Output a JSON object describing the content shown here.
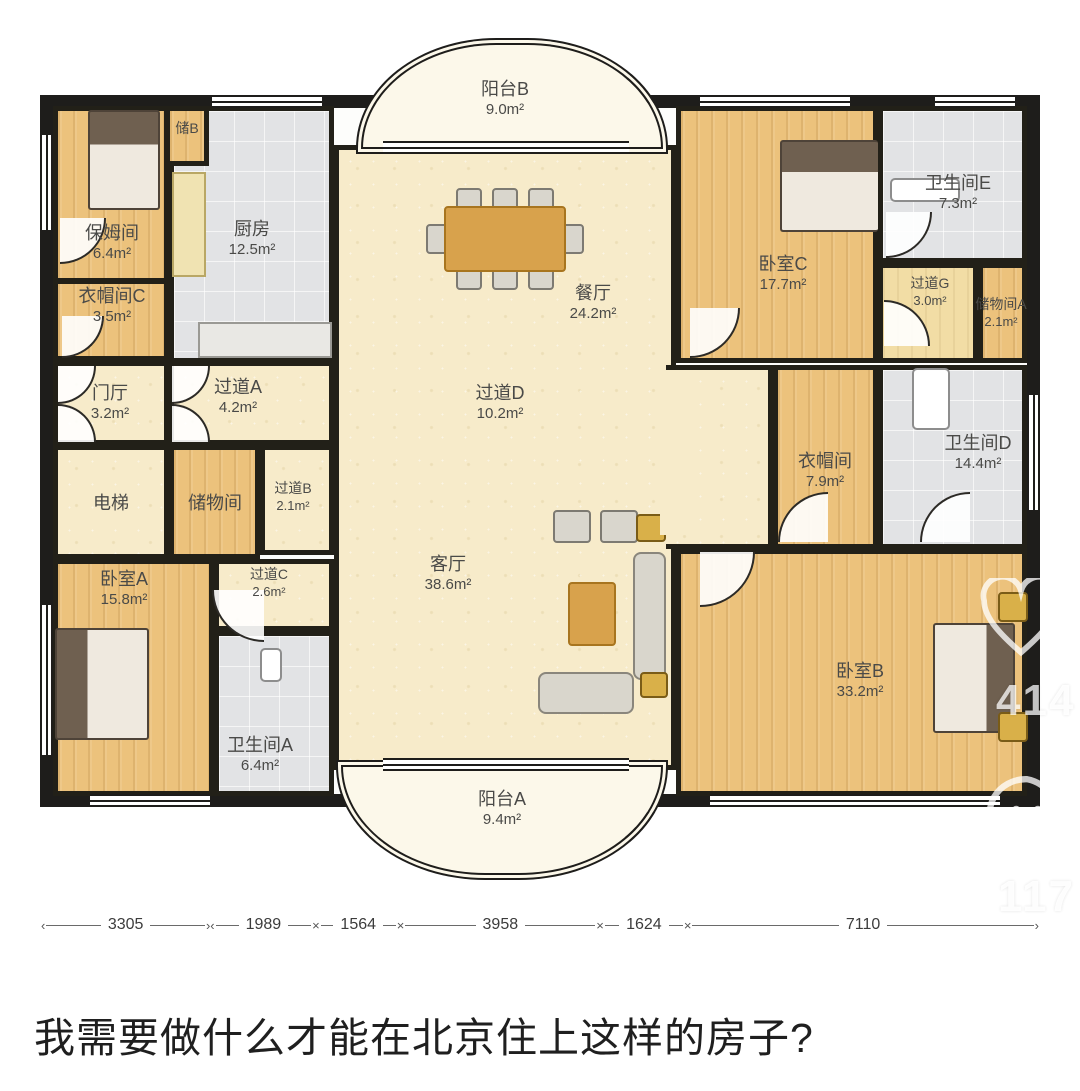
{
  "caption": "我需要做什么才能在北京住上这样的房子?",
  "rooms": {
    "balcony_b": {
      "name": "阳台B",
      "area": "9.0m²"
    },
    "nanny": {
      "name": "保姆间",
      "area": "6.4m²"
    },
    "storage_b": {
      "name": "储B",
      "area": ""
    },
    "kitchen": {
      "name": "厨房",
      "area": "12.5m²"
    },
    "cloak_c": {
      "name": "衣帽间C",
      "area": "3.5m²"
    },
    "foyer": {
      "name": "门厅",
      "area": "3.2m²"
    },
    "hall_a": {
      "name": "过道A",
      "area": "4.2m²"
    },
    "dining": {
      "name": "餐厅",
      "area": "24.2m²"
    },
    "bedroom_c": {
      "name": "卧室C",
      "area": "17.7m²"
    },
    "bath_e": {
      "name": "卫生间E",
      "area": "7.3m²"
    },
    "hall_g": {
      "name": "过道G",
      "area": "3.0m²"
    },
    "storage_a": {
      "name": "储物间A",
      "area": "2.1m²"
    },
    "hall_d": {
      "name": "过道D",
      "area": "10.2m²"
    },
    "elevator": {
      "name": "电梯",
      "area": ""
    },
    "storage": {
      "name": "储物间",
      "area": ""
    },
    "hall_b": {
      "name": "过道B",
      "area": "2.1m²"
    },
    "cloak": {
      "name": "衣帽间",
      "area": "7.9m²"
    },
    "bath_d": {
      "name": "卫生间D",
      "area": "14.4m²"
    },
    "bedroom_a": {
      "name": "卧室A",
      "area": "15.8m²"
    },
    "hall_c": {
      "name": "过道C",
      "area": "2.6m²"
    },
    "living": {
      "name": "客厅",
      "area": "38.6m²"
    },
    "bath_a": {
      "name": "卫生间A",
      "area": "6.4m²"
    },
    "balcony_a": {
      "name": "阳台A",
      "area": "9.4m²"
    },
    "bedroom_b": {
      "name": "卧室B",
      "area": "33.2m²"
    }
  },
  "dimensions": [
    "3305",
    "1989",
    "1564",
    "3958",
    "1624",
    "7110"
  ],
  "watermarks": {
    "like_count": "414",
    "comment_count": "117"
  },
  "colors": {
    "wall": "#1e1d1b",
    "wood_floor": "#ecc27c",
    "tile_floor": "#e2e3e5",
    "hall_floor": "#f7ebca",
    "table": "#d8a24c"
  }
}
